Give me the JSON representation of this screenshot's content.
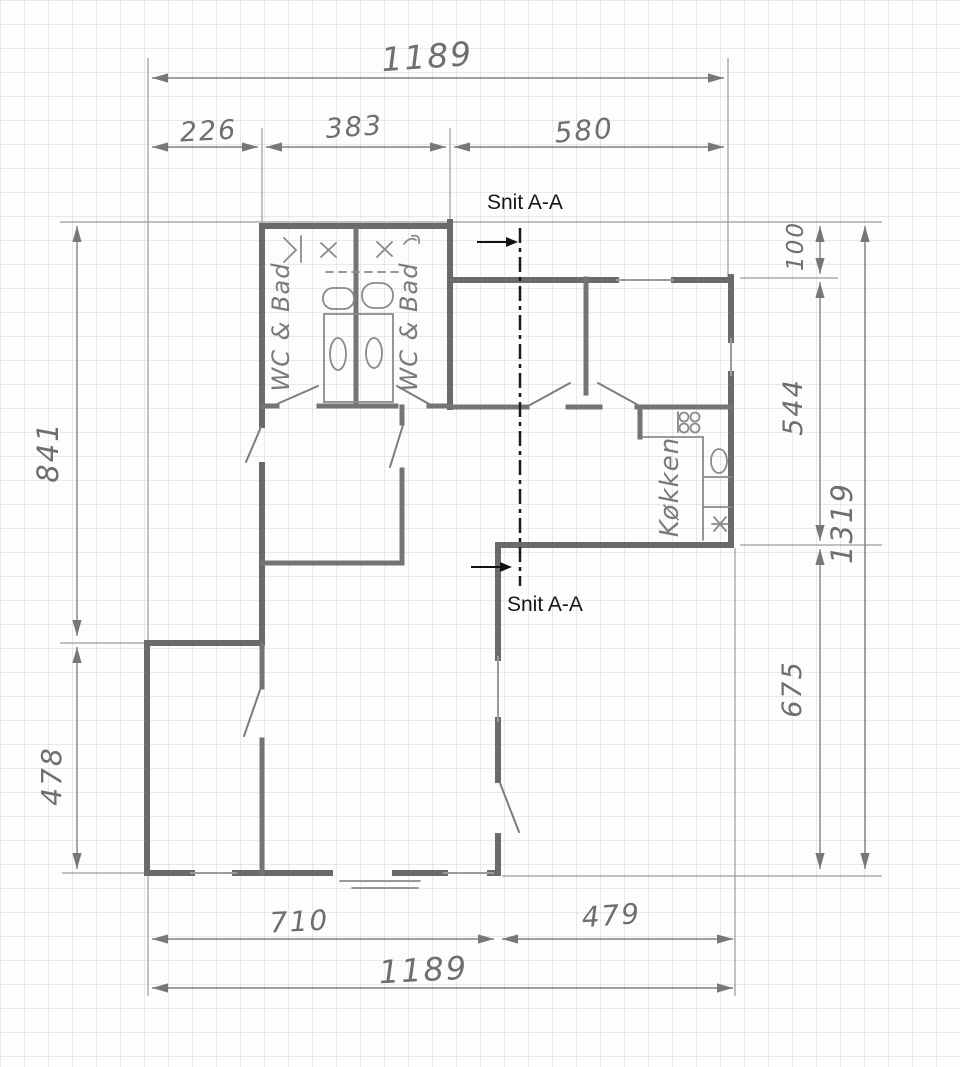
{
  "drawing": {
    "type": "floor-plan-sketch",
    "pencil_color": "#6a6a6a",
    "section_color": "#1c1c1c",
    "paper_color": "#fdfdfb"
  },
  "section_labels": {
    "top": "Snit A-A",
    "bottom": "Snit A-A"
  },
  "rooms": {
    "bath_left": "WC & Bad",
    "bath_right": "WC & Bad",
    "kitchen": "Køkken"
  },
  "dims": {
    "top_total": "1189",
    "seg_226": "226",
    "seg_383": "383",
    "seg_580": "580",
    "left_841": "841",
    "left_478": "478",
    "right_100": "100",
    "right_544": "544",
    "right_675": "675",
    "right_total": "1319",
    "bottom_710": "710",
    "bottom_479": "479",
    "bottom_total": "1189"
  }
}
